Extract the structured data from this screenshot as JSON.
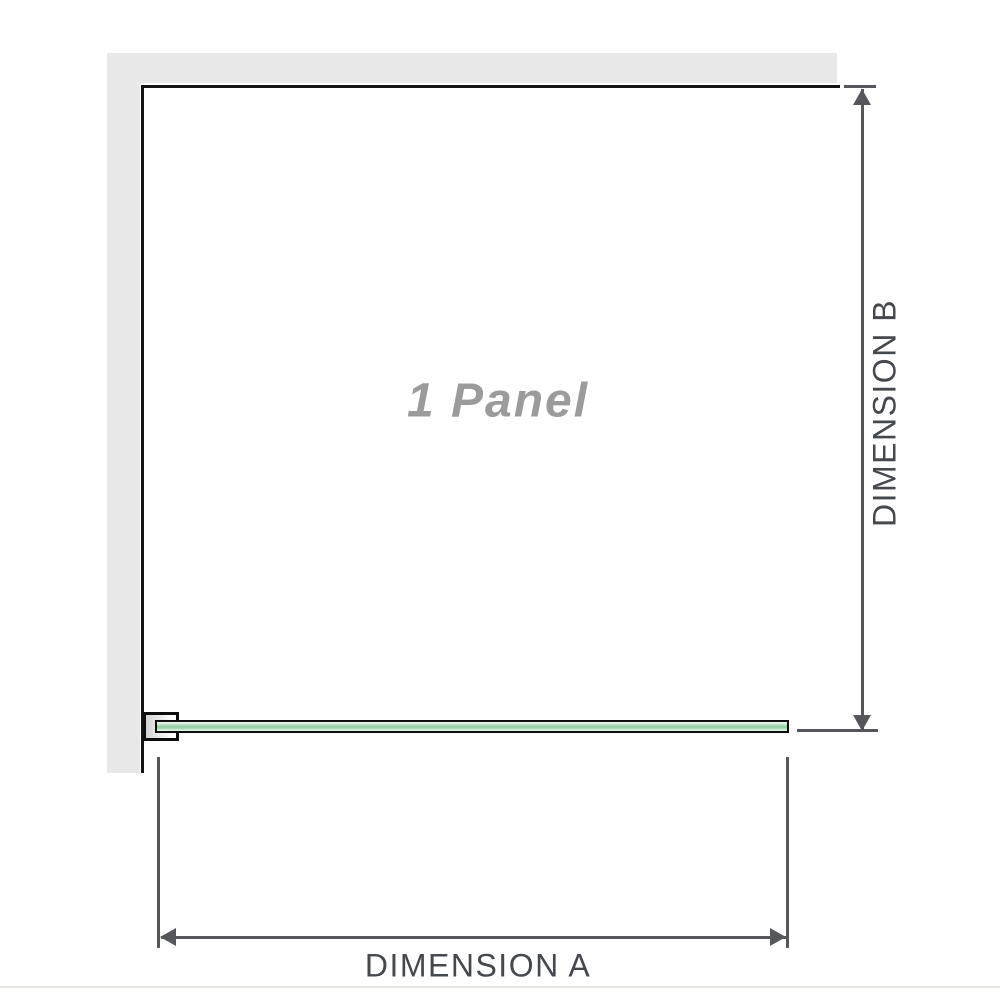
{
  "diagram": {
    "title": "Shower screen panel installation diagram",
    "panel_label": "1 Panel",
    "dimension_a_label": "DIMENSION A",
    "dimension_b_label": "DIMENSION B"
  },
  "colors": {
    "wall": "#e8e8e8",
    "frame-line": "#141414",
    "dimension-line": "#55575b",
    "label-text": "#45484c",
    "panel-label-text": "#9b9b9b",
    "glass-border": "#0d0d0d",
    "glass-mid": "#8fcfa2",
    "glass-light": "#e9f6ed",
    "bracket-fill": "#d3d3d3",
    "baseline-rule": "#e9e6e1",
    "background": "#ffffff"
  }
}
